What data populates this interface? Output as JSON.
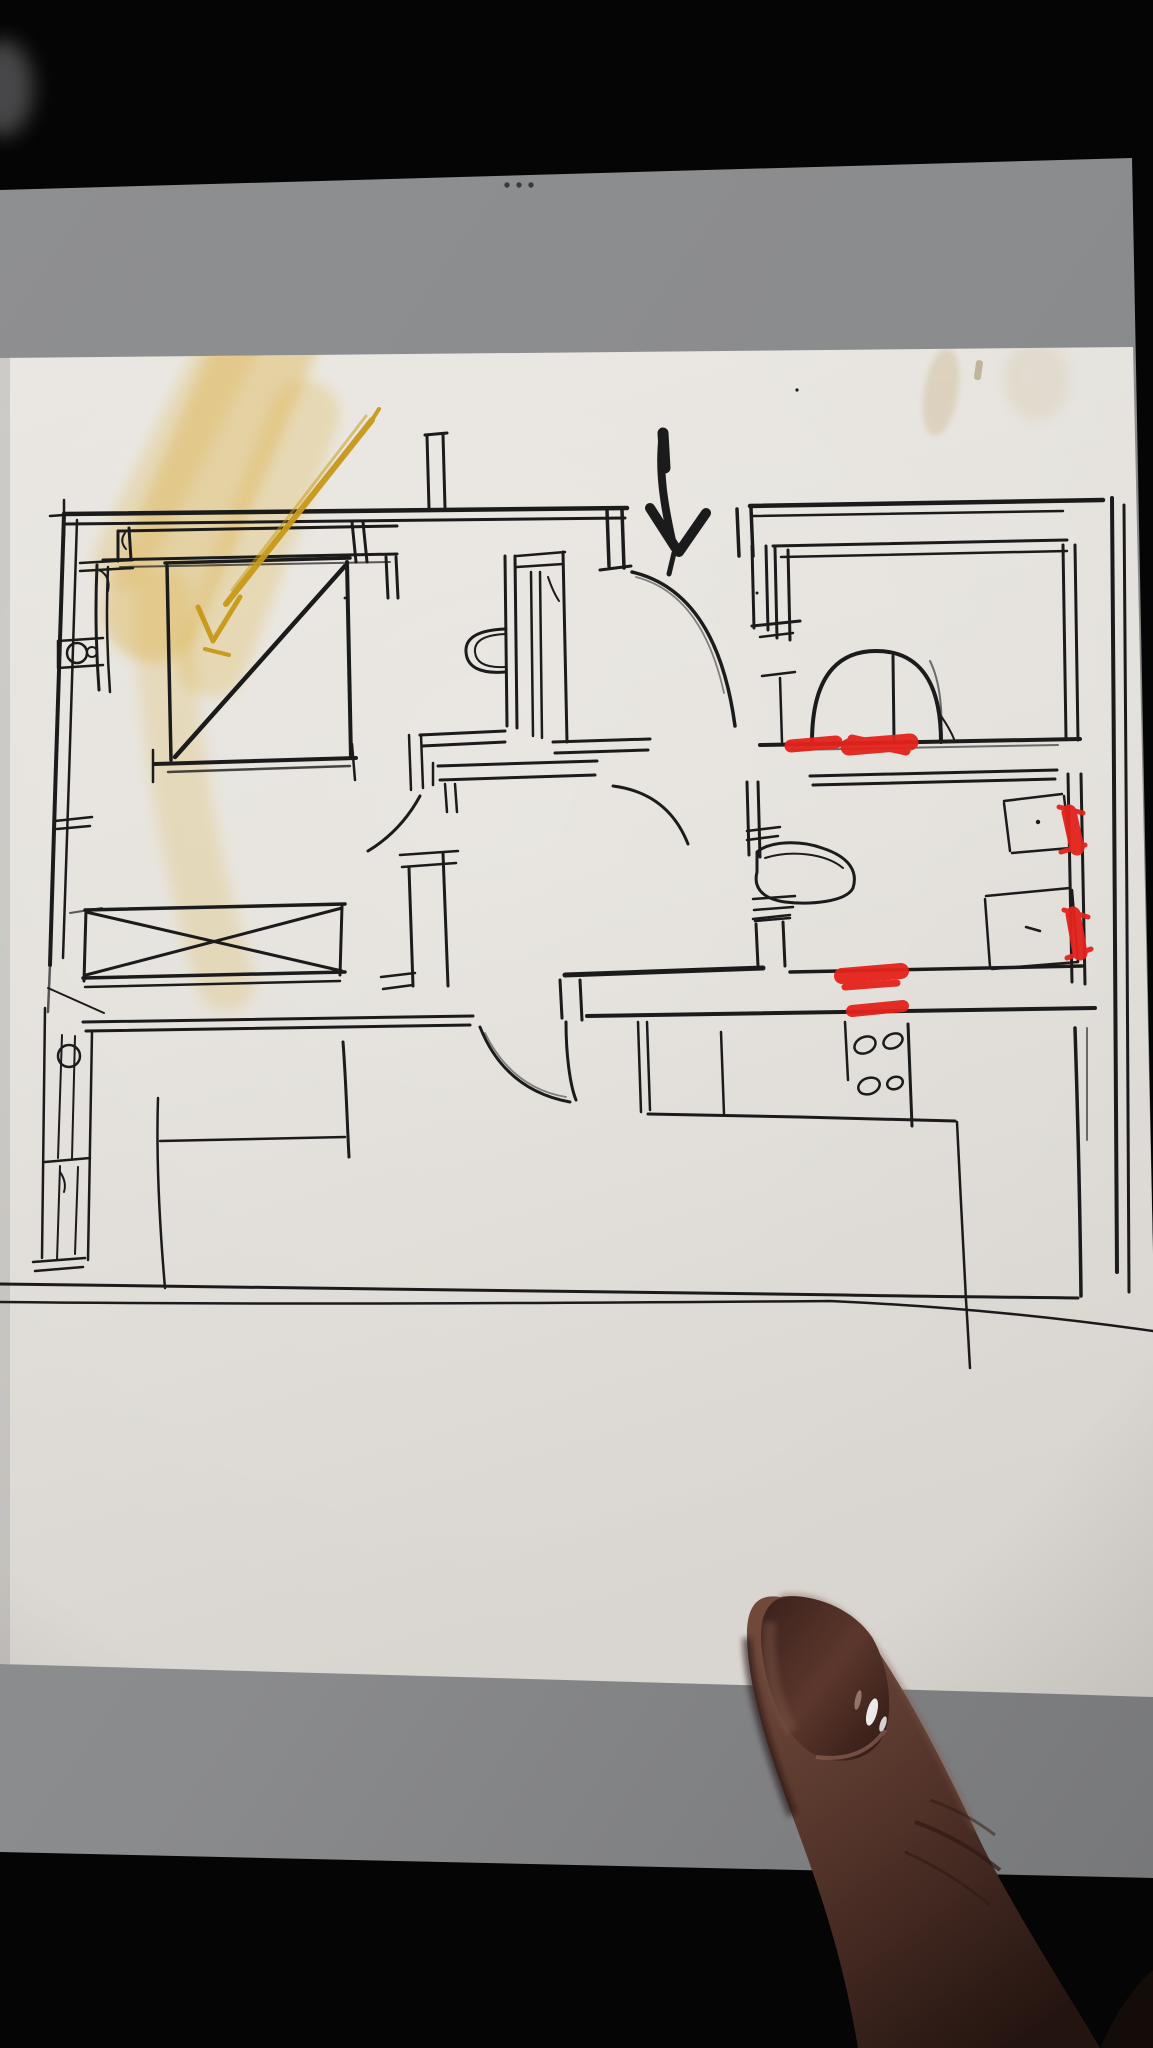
{
  "scene": {
    "description": "Photograph of a tablet screen displaying a hand-drawn apartment floor plan sketch, with a finger pointing at the lower right",
    "background_color": "#050505"
  },
  "tablet": {
    "screen_color": "#8b8c8e",
    "home_indicator": {
      "icon": "three-dots-handle-icon",
      "dot_color": "#3a3a3c",
      "dot_count": 3,
      "dots_cx": [
        507,
        519,
        531
      ],
      "dots_cy": 185,
      "dot_r": 2.7
    }
  },
  "sketch_canvas": {
    "paper_color": "#eae7e2",
    "ink_color": "#1b1b1b",
    "stain_color": "#cdb88e"
  },
  "floor_plan": {
    "style": "hand-drawn ink floor plan",
    "features": [
      "outer-walls",
      "entrance-opening",
      "entrance-door-swing",
      "closet-strip",
      "bed-with-diagonal",
      "headboard",
      "radiator-left-wall",
      "crossed-sofa-box",
      "side-table",
      "hall-walls",
      "wash-basin",
      "wc-toilet",
      "wc-door-swing",
      "shower-dome",
      "desk-quads",
      "kitchen-counter",
      "stove-burners",
      "ground-line"
    ]
  },
  "annotations": {
    "yellow_highlight": {
      "color": "#d9a92a",
      "shape": "diagonal highlighter band upper-left"
    },
    "yellow_arrow": {
      "color": "#c染89a18",
      "direction": "down-left"
    },
    "entrance_arrow": {
      "color": "#1b1b1b",
      "direction": "down"
    },
    "red_marks": {
      "color": "#e6231c",
      "count": 6,
      "items": [
        {
          "x1": 791,
          "y1": 746,
          "x2": 836,
          "y2": 742,
          "w": 13
        },
        {
          "x1": 852,
          "y1": 739,
          "x2": 906,
          "y2": 751,
          "w": 9
        },
        {
          "x1": 849,
          "y1": 747,
          "x2": 910,
          "y2": 742,
          "w": 17
        },
        {
          "x1": 1069,
          "y1": 812,
          "x2": 1077,
          "y2": 848,
          "w": 15
        },
        {
          "x1": 1059,
          "y1": 807,
          "x2": 1083,
          "y2": 813,
          "w": 5
        },
        {
          "x1": 1061,
          "y1": 852,
          "x2": 1085,
          "y2": 845,
          "w": 5
        },
        {
          "x1": 1073,
          "y1": 914,
          "x2": 1080,
          "y2": 953,
          "w": 15
        },
        {
          "x1": 1064,
          "y1": 910,
          "x2": 1088,
          "y2": 917,
          "w": 5
        },
        {
          "x1": 1067,
          "y1": 958,
          "x2": 1091,
          "y2": 949,
          "w": 5
        },
        {
          "x1": 842,
          "y1": 976,
          "x2": 901,
          "y2": 971,
          "w": 16
        },
        {
          "x1": 845,
          "y1": 987,
          "x2": 897,
          "y2": 983,
          "w": 7
        },
        {
          "x1": 852,
          "y1": 1011,
          "x2": 903,
          "y2": 1006,
          "w": 12
        }
      ]
    }
  },
  "finger": {
    "skin_color": "#5f3e32",
    "nail_color": "#46291f",
    "position": "bottom-right pointing at sketch"
  }
}
